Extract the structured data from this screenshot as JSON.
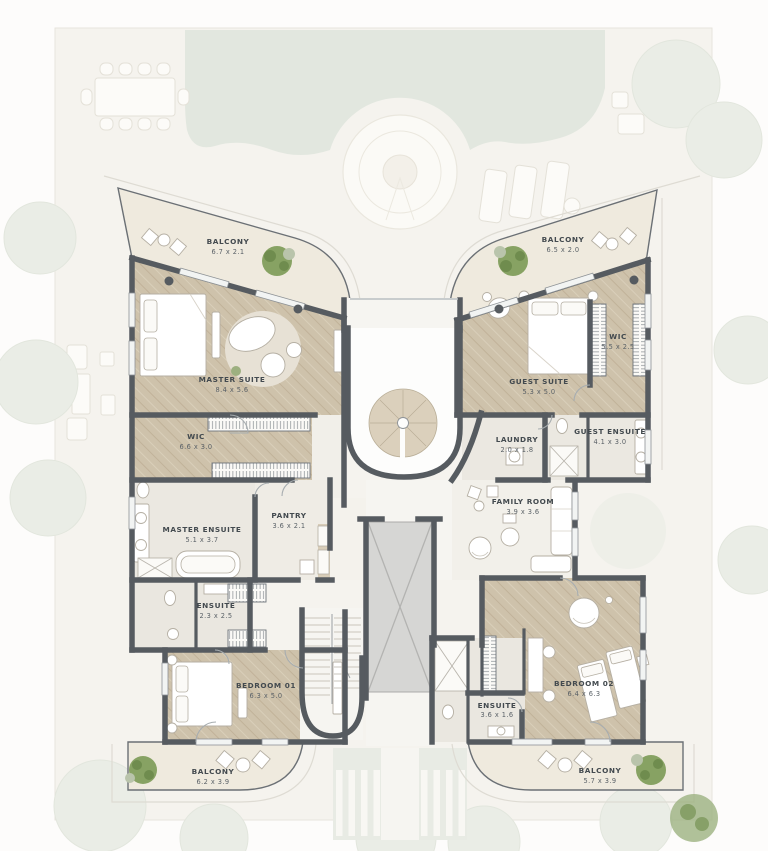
{
  "plan": {
    "type": "residential floor plan",
    "style": "butterfly twin-wing villa level"
  },
  "colors": {
    "wall": "#565b60",
    "wood_floor": "#cec2ab",
    "bath_floor": "#ebe8e1",
    "balcony_floor": "#efeade",
    "site_background": "#f5f3ee",
    "pool": "#e2e7df",
    "plant_green": "#87a263",
    "elevator": "#d6d6d4",
    "label_text": "#434a4f"
  },
  "rooms": {
    "balcony_tl": {
      "name": "BALCONY",
      "dims": "6.7 x 2.1"
    },
    "master_suite": {
      "name": "MASTER SUITE",
      "dims": "8.4 x 5.6"
    },
    "wic_left": {
      "name": "WIC",
      "dims": "6.6 x 3.0"
    },
    "master_ensuite": {
      "name": "MASTER ENSUITE",
      "dims": "5.1 x 3.7"
    },
    "pantry": {
      "name": "PANTRY",
      "dims": "3.6 x 2.1"
    },
    "ensuite_01": {
      "name": "ENSUITE",
      "dims": "2.3 x 2.5"
    },
    "bedroom_01": {
      "name": "BEDROOM 01",
      "dims": "6.3 x 5.0"
    },
    "balcony_bl": {
      "name": "BALCONY",
      "dims": "6.2 x 3.9"
    },
    "balcony_tr": {
      "name": "BALCONY",
      "dims": "6.5 x 2.0"
    },
    "guest_suite": {
      "name": "GUEST SUITE",
      "dims": "5.3 x 5.0"
    },
    "wic_right": {
      "name": "WIC",
      "dims": "5.5 x 2.5"
    },
    "laundry": {
      "name": "LAUNDRY",
      "dims": "2.0 x 1.8"
    },
    "guest_ensuite": {
      "name": "GUEST ENSUITE",
      "dims": "4.1 x 3.0"
    },
    "family_room": {
      "name": "FAMILY ROOM",
      "dims": "3.9 x 3.6"
    },
    "bedroom_02": {
      "name": "BEDROOM 02",
      "dims": "6.4 x 6.3"
    },
    "ensuite_02": {
      "name": "ENSUITE",
      "dims": "3.6 x 1.6"
    },
    "balcony_br": {
      "name": "BALCONY",
      "dims": "5.7 x 3.9"
    }
  }
}
